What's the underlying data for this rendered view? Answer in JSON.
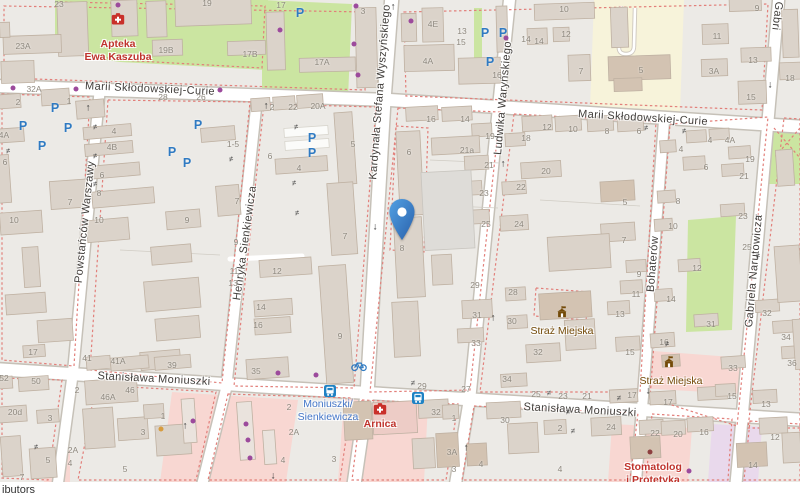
{
  "attribution": {
    "text": "ibutors"
  },
  "marker": {
    "x": 402,
    "y": 241
  },
  "colors": {
    "road": "#ffffff",
    "road_casing": "#c6c1b8",
    "building": "#dbd3ca",
    "building_outline": "#bfb1a2",
    "grass_green": "#cbe5a1",
    "school_yellow": "#f7f3da",
    "retail_pink": "#f8d7d2",
    "commercial_purple": "#e9d9ec",
    "boundary_dash_red": "#e27f7a",
    "marker_blue": "#3b82cc",
    "parking_blue": "#2f7ac2",
    "poi_red": "#bf332c",
    "poi_brown": "#734a08",
    "transit_blue": "#4577c9",
    "house_number_gray": "#8e887e"
  },
  "map_elements": {
    "parking_glyph": "P",
    "streets": [
      {
        "text": "Marii Skłodowskiej-Curie",
        "x": 150,
        "y": 89,
        "rot": 2.5
      },
      {
        "text": "Marii Skłodowskiej-Curie",
        "x": 643,
        "y": 118,
        "rot": 3.5
      },
      {
        "text": "Stanisława Moniuszki",
        "x": 154,
        "y": 379,
        "rot": 3
      },
      {
        "text": "Stanisława Moniuszki",
        "x": 580,
        "y": 410,
        "rot": 3
      },
      {
        "text": "Kardynała Stefana Wyszyńskiego",
        "x": 380,
        "y": 92,
        "rot": -85.5
      },
      {
        "text": "Ludwika Waryńskiego",
        "x": 503,
        "y": 98,
        "rot": -85
      },
      {
        "text": "Henryka Sienkiewicza",
        "x": 245,
        "y": 243,
        "rot": -82
      },
      {
        "text": "Powstańców Warszawy",
        "x": 85,
        "y": 222,
        "rot": -84
      },
      {
        "text": "Bohaterów",
        "x": 653,
        "y": 264,
        "rot": -85.5
      },
      {
        "text": "Gabriela Narutowicza",
        "x": 754,
        "y": 271,
        "rot": -85
      },
      {
        "text": "Gabri",
        "x": 777,
        "y": 16,
        "rot": 97
      }
    ],
    "house_numbers": [
      [
        "23",
        59,
        4
      ],
      [
        "19",
        207,
        3
      ],
      [
        "17",
        281,
        5
      ],
      [
        "3",
        363,
        11
      ],
      [
        "10",
        564,
        9
      ],
      [
        "9",
        757,
        8
      ],
      [
        "4E",
        433,
        24
      ],
      [
        "13",
        462,
        31
      ],
      [
        "11",
        717,
        36
      ],
      [
        "12",
        566,
        34
      ],
      [
        "14",
        539,
        41
      ],
      [
        "15",
        461,
        42
      ],
      [
        "14",
        526,
        39
      ],
      [
        "23A",
        23,
        46
      ],
      [
        "19B",
        166,
        50
      ],
      [
        "17B",
        250,
        54
      ],
      [
        "13",
        753,
        60
      ],
      [
        "17A",
        322,
        62
      ],
      [
        "4A",
        428,
        61
      ],
      [
        "3A",
        714,
        71
      ],
      [
        "5",
        641,
        70
      ],
      [
        "7",
        581,
        71
      ],
      [
        "16",
        497,
        75
      ],
      [
        "18",
        790,
        78
      ],
      [
        "32A",
        34,
        89
      ],
      [
        "15",
        751,
        97
      ],
      [
        "28",
        163,
        97
      ],
      [
        "26",
        201,
        97
      ],
      [
        "2",
        18,
        102
      ],
      [
        "1",
        69,
        101
      ],
      [
        "2",
        272,
        107
      ],
      [
        "22",
        293,
        107
      ],
      [
        "20A",
        318,
        106
      ],
      [
        "12",
        547,
        127
      ],
      [
        "18",
        526,
        138
      ],
      [
        "10",
        573,
        129
      ],
      [
        "8",
        607,
        131
      ],
      [
        "6",
        639,
        131
      ],
      [
        "4",
        114,
        131
      ],
      [
        "4B",
        112,
        147
      ],
      [
        "4A",
        4,
        135
      ],
      [
        "1-5",
        233,
        144
      ],
      [
        "16",
        431,
        119
      ],
      [
        "14",
        465,
        119
      ],
      [
        "19",
        490,
        136
      ],
      [
        "6",
        409,
        152
      ],
      [
        "21a",
        467,
        150
      ],
      [
        "5",
        353,
        144
      ],
      [
        "6",
        270,
        156
      ],
      [
        "4",
        299,
        168
      ],
      [
        "6",
        5,
        162
      ],
      [
        "6",
        102,
        175
      ],
      [
        "21",
        489,
        165
      ],
      [
        "20",
        546,
        171
      ],
      [
        "22",
        521,
        187
      ],
      [
        "23",
        484,
        193
      ],
      [
        "4",
        710,
        140
      ],
      [
        "4A",
        730,
        140
      ],
      [
        "4",
        681,
        149
      ],
      [
        "19",
        750,
        159
      ],
      [
        "6",
        706,
        167
      ],
      [
        "21",
        744,
        176
      ],
      [
        "8",
        99,
        193
      ],
      [
        "7",
        70,
        202
      ],
      [
        "7",
        237,
        201
      ],
      [
        "5",
        625,
        202
      ],
      [
        "8",
        678,
        201
      ],
      [
        "10",
        14,
        220
      ],
      [
        "10",
        99,
        220
      ],
      [
        "9",
        187,
        220
      ],
      [
        "24",
        519,
        224
      ],
      [
        "25",
        486,
        224
      ],
      [
        "23",
        743,
        216
      ],
      [
        "10",
        673,
        226
      ],
      [
        "7",
        345,
        236
      ],
      [
        "7",
        624,
        240
      ],
      [
        "9",
        236,
        242
      ],
      [
        "25",
        747,
        247
      ],
      [
        "8",
        402,
        248
      ],
      [
        "12",
        277,
        271
      ],
      [
        "11",
        234,
        271
      ],
      [
        "13",
        233,
        283
      ],
      [
        "12",
        697,
        268
      ],
      [
        "9",
        639,
        274
      ],
      [
        "29",
        475,
        285
      ],
      [
        "28",
        513,
        292
      ],
      [
        "11",
        636,
        294
      ],
      [
        "14",
        671,
        299
      ],
      [
        "14",
        261,
        307
      ],
      [
        "16",
        258,
        325
      ],
      [
        "31",
        477,
        315
      ],
      [
        "30",
        512,
        321
      ],
      [
        "13",
        620,
        314
      ],
      [
        "31",
        711,
        324
      ],
      [
        "32",
        767,
        313
      ],
      [
        "9",
        340,
        336
      ],
      [
        "15",
        630,
        352
      ],
      [
        "16",
        664,
        342
      ],
      [
        "32",
        538,
        352
      ],
      [
        "33",
        476,
        343
      ],
      [
        "34",
        786,
        337
      ],
      [
        "17",
        33,
        352
      ],
      [
        "41",
        87,
        358
      ],
      [
        "41A",
        118,
        361
      ],
      [
        "39",
        172,
        365
      ],
      [
        "35",
        256,
        371
      ],
      [
        "33",
        733,
        368
      ],
      [
        "36",
        792,
        363
      ],
      [
        "34",
        507,
        379
      ],
      [
        "52",
        4,
        378
      ],
      [
        "50",
        36,
        381
      ],
      [
        "2",
        77,
        390
      ],
      [
        "46",
        130,
        390
      ],
      [
        "29",
        422,
        386
      ],
      [
        "27",
        466,
        389
      ],
      [
        "25",
        536,
        394
      ],
      [
        "23",
        563,
        396
      ],
      [
        "21",
        587,
        396
      ],
      [
        "17",
        632,
        395
      ],
      [
        "15",
        732,
        396
      ],
      [
        "17",
        668,
        402
      ],
      [
        "46A",
        108,
        397
      ],
      [
        "2",
        289,
        407
      ],
      [
        "13",
        766,
        404
      ],
      [
        "20d",
        15,
        412
      ],
      [
        "32",
        436,
        412
      ],
      [
        "1",
        163,
        416
      ],
      [
        "1",
        454,
        418
      ],
      [
        "3",
        50,
        418
      ],
      [
        "30",
        505,
        420
      ],
      [
        "24",
        611,
        427
      ],
      [
        "2",
        560,
        428
      ],
      [
        "22",
        655,
        433
      ],
      [
        "20",
        678,
        434
      ],
      [
        "16",
        704,
        432
      ],
      [
        "2A",
        294,
        432
      ],
      [
        "3",
        143,
        432
      ],
      [
        "12",
        775,
        437
      ],
      [
        "2A",
        73,
        450
      ],
      [
        "3A",
        452,
        452
      ],
      [
        "5",
        48,
        460
      ],
      [
        "3",
        334,
        459
      ],
      [
        "4",
        283,
        460
      ],
      [
        "4",
        70,
        463
      ],
      [
        "4",
        481,
        464
      ],
      [
        "14",
        753,
        465
      ],
      [
        "4",
        560,
        469
      ],
      [
        "5",
        125,
        469
      ],
      [
        "3",
        454,
        469
      ],
      [
        "7",
        22,
        477
      ]
    ],
    "pois": [
      {
        "id": "apteka-ewa-kaszuba",
        "lines": [
          "Apteka",
          "Ewa Kaszuba"
        ],
        "x": 118,
        "y": 38,
        "cls": "poi-red",
        "icon": "pharmacy-icon",
        "ix": 118,
        "iy": 19
      },
      {
        "id": "arnica",
        "lines": [
          "Arnica"
        ],
        "x": 380,
        "y": 418,
        "cls": "poi-red",
        "icon": "pharmacy-icon",
        "ix": 380,
        "iy": 409
      },
      {
        "id": "stomatolog-i-protetyka",
        "lines": [
          "Stomatolog",
          "i Protetyka"
        ],
        "x": 653,
        "y": 461,
        "cls": "poi-red",
        "icon": null
      },
      {
        "id": "straz-miejska-1",
        "lines": [
          "Straż Miejska"
        ],
        "x": 562,
        "y": 325,
        "cls": "poi-brown",
        "icon": "townhall-icon",
        "ix": 562,
        "iy": 312
      },
      {
        "id": "straz-miejska-2",
        "lines": [
          "Straż Miejska"
        ],
        "x": 671,
        "y": 375,
        "cls": "poi-brown",
        "icon": "townhall-icon",
        "ix": 669,
        "iy": 362
      },
      {
        "id": "stop-moniuszki-sienkiewicza",
        "lines": [
          "Moniuszki/",
          "Sienkiewicza"
        ],
        "x": 328,
        "y": 398,
        "cls": "poi-blue",
        "icon": null
      }
    ],
    "transit_icons": [
      {
        "icon": "bus-stop-icon",
        "x": 330,
        "y": 391
      },
      {
        "icon": "bus-stop-icon",
        "x": 418,
        "y": 398
      },
      {
        "icon": "bicycle-parking-icon",
        "x": 359,
        "y": 366
      }
    ],
    "parking": [
      [
        300,
        13
      ],
      [
        485,
        33
      ],
      [
        503,
        33
      ],
      [
        490,
        62
      ],
      [
        55,
        108
      ],
      [
        23,
        126
      ],
      [
        68,
        128
      ],
      [
        42,
        146
      ],
      [
        198,
        125
      ],
      [
        172,
        152
      ],
      [
        187,
        163
      ],
      [
        312,
        138
      ],
      [
        312,
        153
      ]
    ],
    "oneway_arrows": [
      {
        "dir": "up",
        "x": 393,
        "y": 7
      },
      {
        "dir": "up",
        "x": 88,
        "y": 108
      },
      {
        "dir": "up",
        "x": 266,
        "y": 106
      },
      {
        "dir": "up",
        "x": 503,
        "y": 164
      },
      {
        "dir": "up",
        "x": 493,
        "y": 318
      },
      {
        "dir": "up",
        "x": 185,
        "y": 426
      },
      {
        "dir": "up",
        "x": 466,
        "y": 448
      },
      {
        "dir": "down",
        "x": 375,
        "y": 227
      },
      {
        "dir": "down",
        "x": 770,
        "y": 85
      },
      {
        "dir": "down",
        "x": 756,
        "y": 217
      },
      {
        "dir": "down",
        "x": 273,
        "y": 476
      },
      {
        "dir": "down",
        "x": 648,
        "y": 391
      }
    ],
    "gates": [
      [
        95,
        127,
        -4
      ],
      [
        95,
        156,
        -4
      ],
      [
        95,
        184,
        -4
      ],
      [
        8,
        151,
        -4
      ],
      [
        231,
        159,
        -6
      ],
      [
        296,
        127,
        -4
      ],
      [
        294,
        183,
        -4
      ],
      [
        297,
        213,
        -4
      ],
      [
        413,
        383,
        3
      ],
      [
        549,
        393,
        3
      ],
      [
        667,
        344,
        -5
      ],
      [
        619,
        398,
        3
      ],
      [
        573,
        431,
        3
      ],
      [
        684,
        131,
        -4
      ],
      [
        646,
        128,
        -4
      ],
      [
        758,
        256,
        -5
      ],
      [
        36,
        447,
        -4
      ],
      [
        568,
        412,
        3
      ]
    ],
    "dots": [
      {
        "x": 118,
        "y": 5,
        "c": "#9c4a9c"
      },
      {
        "x": 13,
        "y": 88,
        "c": "#9c4a9c"
      },
      {
        "x": 76,
        "y": 89,
        "c": "#9c4a9c"
      },
      {
        "x": 220,
        "y": 90,
        "c": "#9c4a9c"
      },
      {
        "x": 356,
        "y": 6,
        "c": "#9c4a9c"
      },
      {
        "x": 411,
        "y": 21,
        "c": "#9c4a9c"
      },
      {
        "x": 354,
        "y": 44,
        "c": "#9c4a9c"
      },
      {
        "x": 358,
        "y": 75,
        "c": "#9c4a9c"
      },
      {
        "x": 506,
        "y": 38,
        "c": "#9c4a9c"
      },
      {
        "x": 280,
        "y": 30,
        "c": "#9c4a9c"
      },
      {
        "x": 278,
        "y": 373,
        "c": "#9c4a9c"
      },
      {
        "x": 316,
        "y": 375,
        "c": "#9c4a9c"
      },
      {
        "x": 193,
        "y": 421,
        "c": "#9c4a9c"
      },
      {
        "x": 246,
        "y": 424,
        "c": "#9c4a9c"
      },
      {
        "x": 248,
        "y": 440,
        "c": "#9c4a9c"
      },
      {
        "x": 250,
        "y": 458,
        "c": "#9c4a9c"
      },
      {
        "x": 650,
        "y": 452,
        "c": "#8d3f3f"
      },
      {
        "x": 689,
        "y": 471,
        "c": "#9c4a9c"
      },
      {
        "x": 161,
        "y": 429,
        "c": "#d79c3f"
      }
    ]
  }
}
